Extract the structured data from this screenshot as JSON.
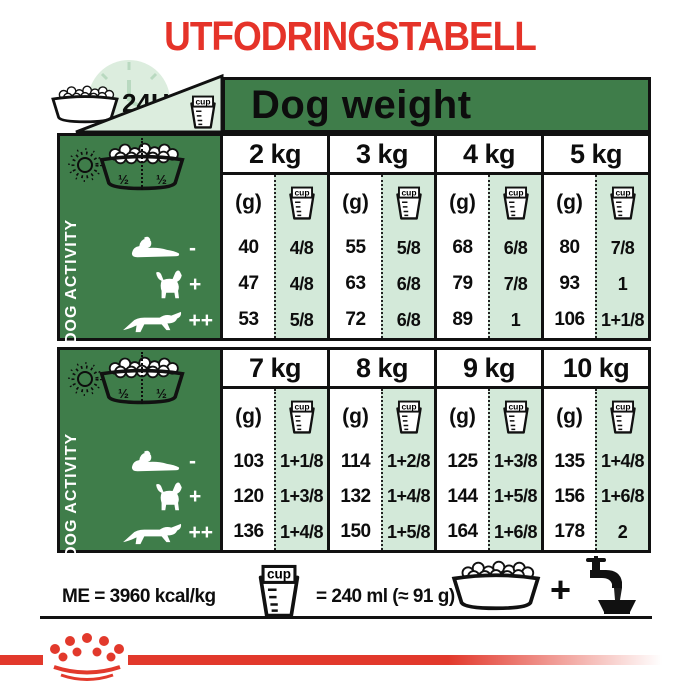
{
  "title": "UTFODRINGSTABELL",
  "colors": {
    "red": "#e53329",
    "green": "#3f7d4a",
    "mint": "#d3e9d9",
    "pale": "#dcedde",
    "tick_green": "#b9d9c0",
    "black": "#111111"
  },
  "header": {
    "hours": "24H",
    "dog_weight": "Dog weight"
  },
  "icons": {
    "cup_label": "cup"
  },
  "activity_panel": {
    "label": "DOG ACTIVITY",
    "half_left": "½",
    "half_right": "½"
  },
  "table": {
    "gram_header": "(g)",
    "sections": [
      {
        "weights": [
          "2 kg",
          "3 kg",
          "4 kg",
          "5 kg"
        ],
        "rows": [
          {
            "marker": "-",
            "grams": [
              "40",
              "55",
              "68",
              "80"
            ],
            "cups": [
              "4/8",
              "5/8",
              "6/8",
              "7/8"
            ]
          },
          {
            "marker": "+",
            "grams": [
              "47",
              "63",
              "79",
              "93"
            ],
            "cups": [
              "4/8",
              "6/8",
              "7/8",
              "1"
            ]
          },
          {
            "marker": "++",
            "grams": [
              "53",
              "72",
              "89",
              "106"
            ],
            "cups": [
              "5/8",
              "6/8",
              "1",
              "1+1/8"
            ]
          }
        ]
      },
      {
        "weights": [
          "7 kg",
          "8 kg",
          "9 kg",
          "10 kg"
        ],
        "rows": [
          {
            "marker": "-",
            "grams": [
              "103",
              "114",
              "125",
              "135"
            ],
            "cups": [
              "1+1/8",
              "1+2/8",
              "1+3/8",
              "1+4/8"
            ]
          },
          {
            "marker": "+",
            "grams": [
              "120",
              "132",
              "144",
              "156"
            ],
            "cups": [
              "1+3/8",
              "1+4/8",
              "1+5/8",
              "1+6/8"
            ]
          },
          {
            "marker": "++",
            "grams": [
              "136",
              "150",
              "164",
              "178"
            ],
            "cups": [
              "1+4/8",
              "1+5/8",
              "1+6/8",
              "2"
            ]
          }
        ]
      }
    ]
  },
  "footer": {
    "me": "ME = 3960 kcal/kg",
    "cup_equals": "= 240 ml (≈ 91 g)",
    "plus": "+"
  }
}
